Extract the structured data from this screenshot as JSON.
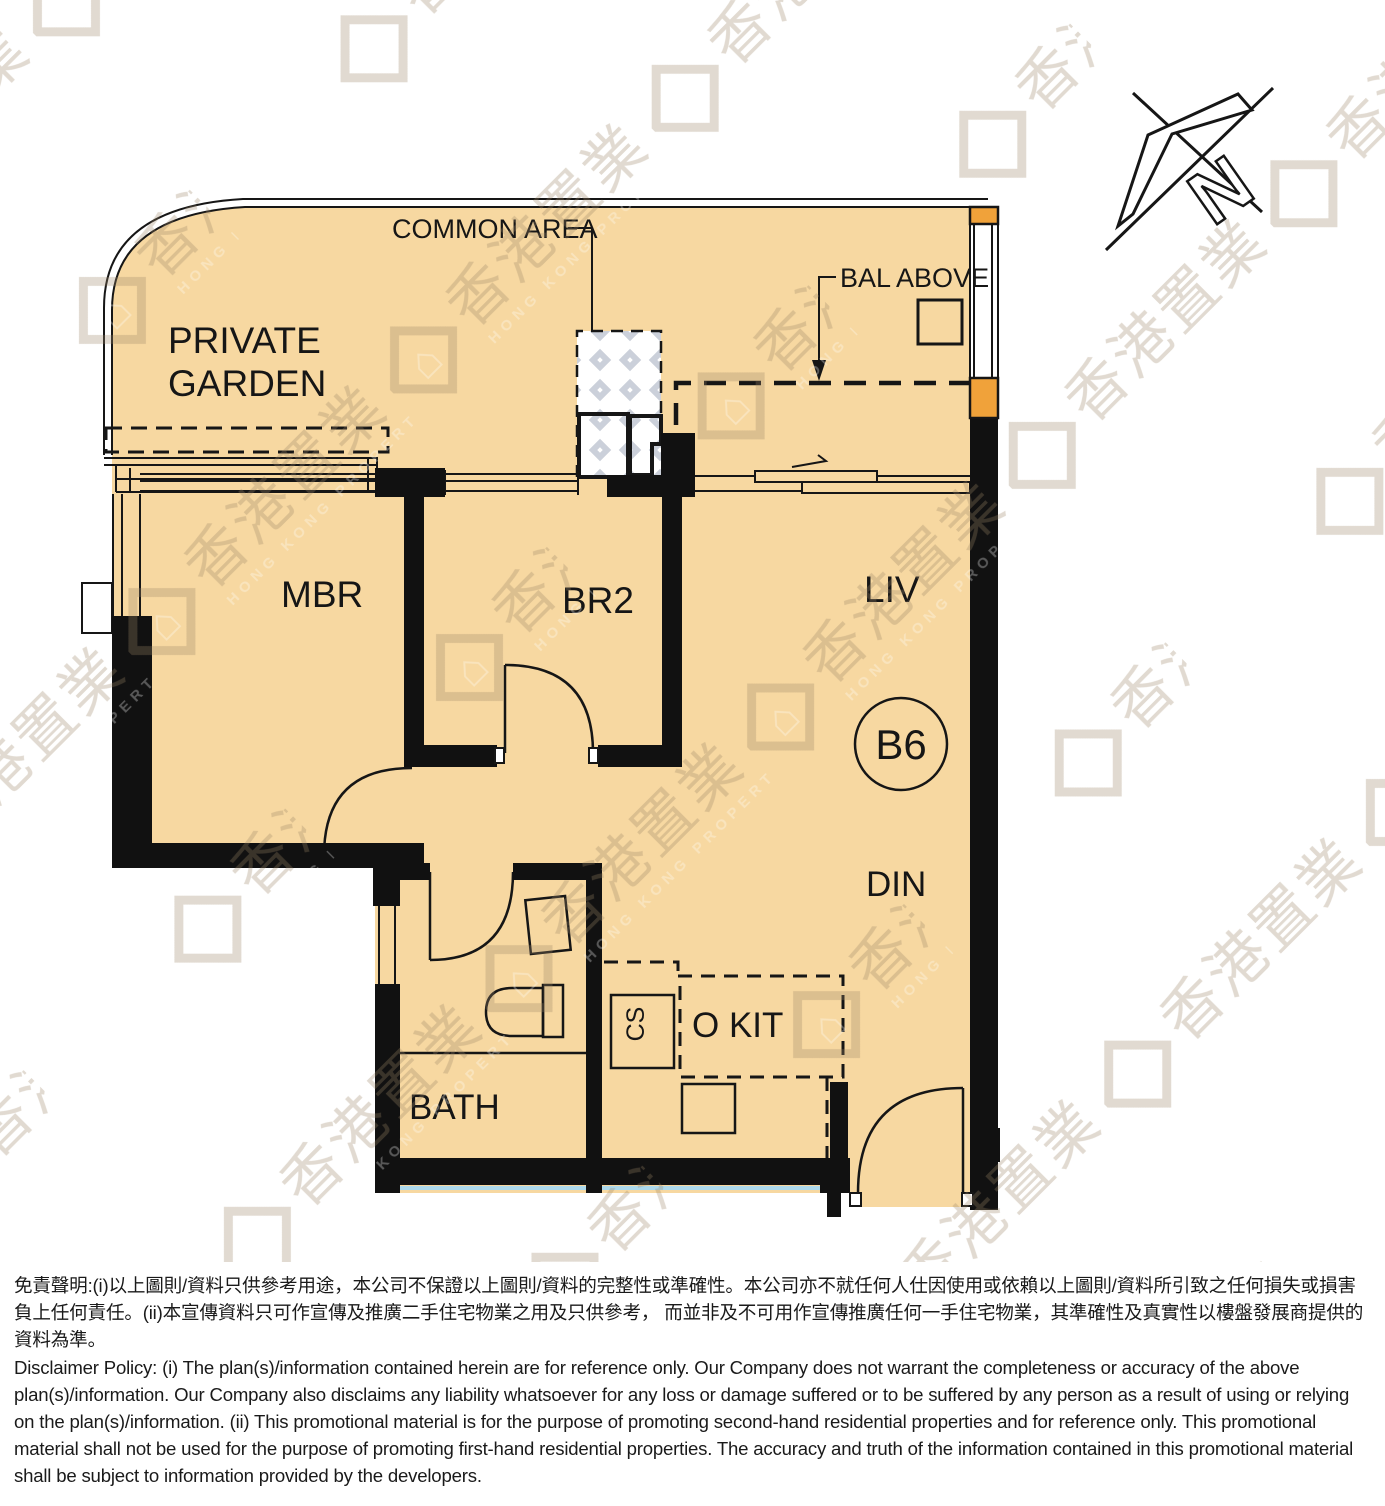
{
  "plan": {
    "rooms": {
      "private_garden": {
        "line1": "PRIVATE",
        "line2": "GARDEN"
      },
      "master_bedroom": "MBR",
      "bedroom2": "BR2",
      "living": "LIV",
      "dining": "DIN",
      "bath": "BATH",
      "open_kitchen": "O KIT",
      "cabinet": "CS"
    },
    "annotations": {
      "common_area": "COMMON AREA",
      "balcony_above": "BAL ABOVE",
      "unit_label": "B6",
      "north_letter": "N"
    },
    "colors": {
      "floor": "#F7D8A1",
      "wall": "#111111",
      "window_accent_orange": "#F0A23A",
      "hatch_line": "#CBD0DA",
      "exterior_blue_line": "#ACD9EC"
    }
  },
  "watermark": {
    "cjk": "香港置業",
    "latin": "HONG KONG PROPERTY",
    "house_glyph": "⌂"
  },
  "disclaimer": {
    "chinese": "免責聲明:(i)以上圖則/資料只供參考用途，本公司不保證以上圖則/資料的完整性或準確性。本公司亦不就任何人仕因使用或依賴以上圖則/資料所引致之任何損失或損害負上任何責任。(ii)本宣傳資料只可作宣傳及推廣二手住宅物業之用及只供參考， 而並非及不可用作宣傳推廣任何一手住宅物業，其準確性及真實性以樓盤發展商提供的資料為準。",
    "english": "Disclaimer Policy: (i) The plan(s)/information contained herein are for reference only. Our Company does not warrant the completeness or accuracy of the above plan(s)/information. Our Company also disclaims any liability whatsoever for any loss or damage suffered or to be suffered by any person as a result of using or relying on the plan(s)/information. (ii) This promotional material is for the purpose of promoting second-hand residential properties and for reference only. This promotional material shall not be used for the purpose of promoting first-hand residential properties. The accuracy and truth of the information contained in this promotional material shall be subject to information provided by the developers."
  }
}
